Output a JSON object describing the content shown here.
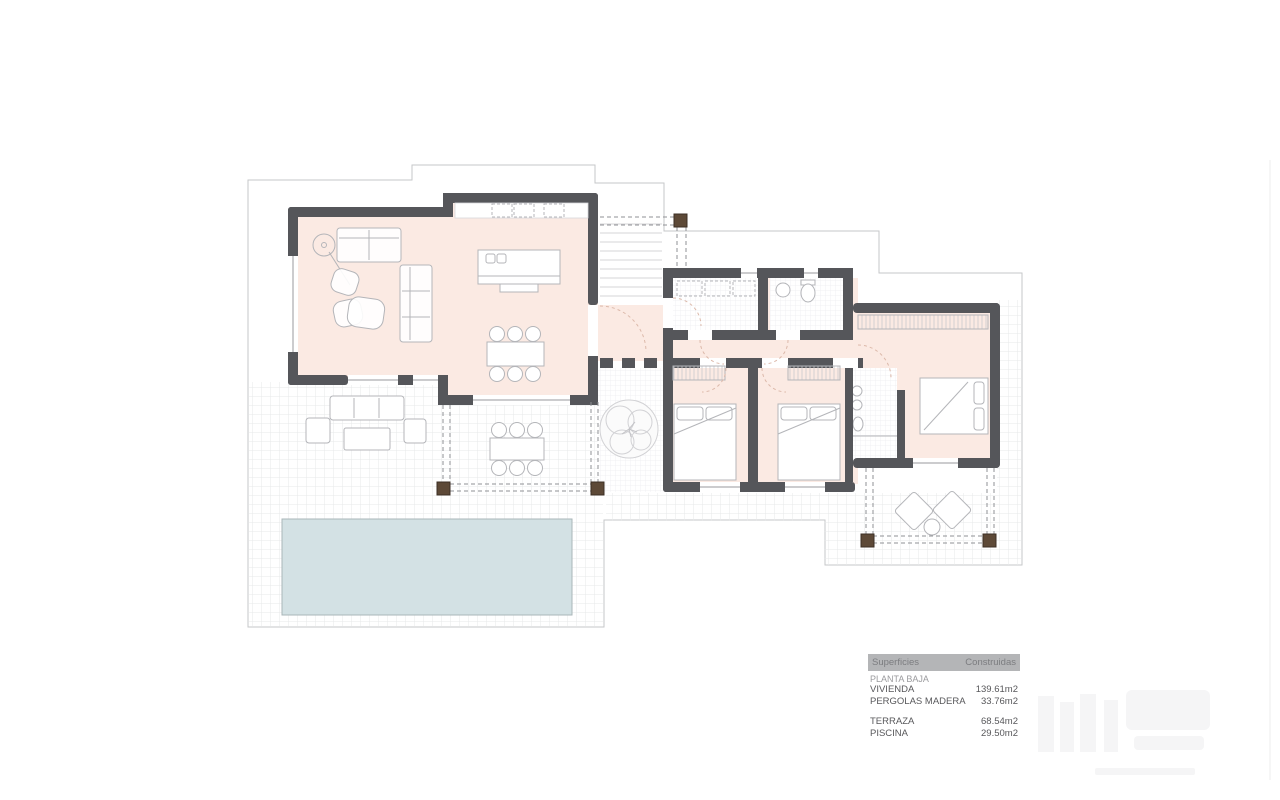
{
  "document": {
    "type": "architectural-floor-plan",
    "floor": "ground floor"
  },
  "surfaces_table": {
    "header_col1": "Superficies",
    "header_col2": "Construidas",
    "section_label": "PLANTA BAJA",
    "rows": [
      {
        "label": "VIVIENDA",
        "value": "139.61m2"
      },
      {
        "label": "PERGOLAS MADERA",
        "value": "33.76m2"
      },
      {
        "label": "TERRAZA",
        "value": "68.54m2"
      },
      {
        "label": "PISCINA",
        "value": "29.50m2"
      }
    ]
  },
  "colors": {
    "wall": "#55565a",
    "floor": "#fbeae3",
    "pool": "#d3e1e4",
    "pool_border": "#a9b6b8",
    "terrace_grid": "#e7e8ea",
    "tile": "#ededf0",
    "boundary": "#c6c7c9",
    "furniture": "#b4b5b9",
    "pergola_post": "#5d4937",
    "pergola_post_border": "#3c2f24",
    "pergola_dash": "#8f9094",
    "door_arc": "#dcb9aa",
    "steps": "#d4d4d7",
    "window_line": "#9a9a9e",
    "table_header_bg": "#b4b5b7",
    "table_header_text": "#7c7d80",
    "table_text": "#58585b",
    "table_muted": "#9b9b9e",
    "watermark": "#f5f5f6"
  }
}
